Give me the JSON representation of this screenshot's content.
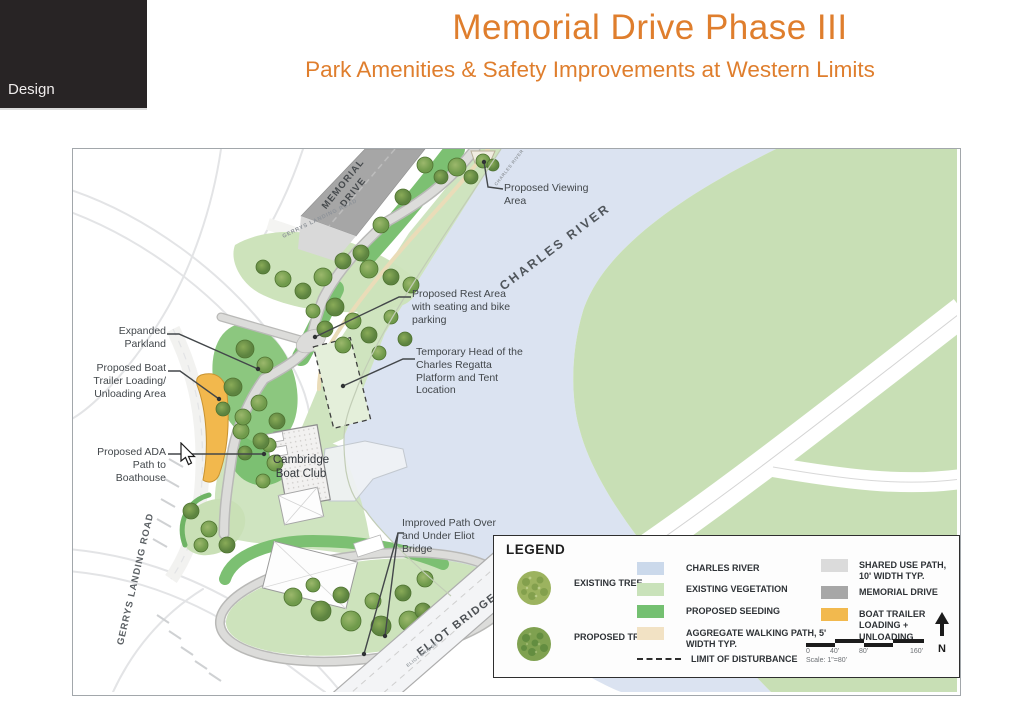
{
  "slide": {
    "section_label": "Design",
    "title": "Memorial Drive Phase III",
    "subtitle": "Park Amenities & Safety Improvements at Western Limits"
  },
  "map": {
    "road_labels": {
      "memorial_drive": "MEMORIAL DRIVE",
      "charles_river": "CHARLES RIVER",
      "charles_river_small": "CHARLES RIVER",
      "gerrys_landing_top": "GERRYS LANDING ROAD",
      "gerrys_landing_left": "GERRYS LANDING ROAD",
      "eliot_bridge": "ELIOT BRIDGE",
      "eliot_bridge_small": "ELIOT BRIDGE"
    },
    "annotations": {
      "viewing_area": "Proposed Viewing Area",
      "rest_area": "Proposed Rest Area with seating and bike parking",
      "regatta": "Temporary Head of the Charles Regatta Platform and Tent Location",
      "expanded_parkland": "Expanded Parkland",
      "boat_trailer": "Proposed Boat Trailer Loading/ Unloading Area",
      "ada_path": "Proposed ADA Path to Boathouse",
      "boat_club": "Cambridge Boat Club",
      "improved_path": "Improved Path Over and Under Eliot Bridge"
    }
  },
  "legend": {
    "title": "LEGEND",
    "trees": [
      {
        "label": "EXISTING TREE"
      },
      {
        "label": "PROPOSED TREE"
      }
    ],
    "areas": [
      {
        "label": "CHARLES RIVER",
        "color": "#cbd9eb"
      },
      {
        "label": "EXISTING VEGETATION",
        "color": "#c9e2ba"
      },
      {
        "label": "PROPOSED SEEDING",
        "color": "#74c071"
      },
      {
        "label": "AGGREGATE WALKING PATH, 5' WIDTH TYP.",
        "color": "#f2e2c4"
      },
      {
        "label": "LIMIT OF DISTURBANCE",
        "style": "dashed"
      }
    ],
    "paths": [
      {
        "label": "SHARED USE PATH, 10' WIDTH TYP.",
        "color": "#dbdbdb"
      },
      {
        "label": "MEMORIAL DRIVE",
        "color": "#a7a7a7"
      },
      {
        "label": "BOAT TRAILER LOADING + UNLOADING",
        "color": "#f2b94e"
      }
    ],
    "scale": {
      "ticks": [
        "0",
        "40'",
        "80'",
        "160'"
      ],
      "note": "Scale: 1\"=80'"
    },
    "north_label": "N"
  }
}
